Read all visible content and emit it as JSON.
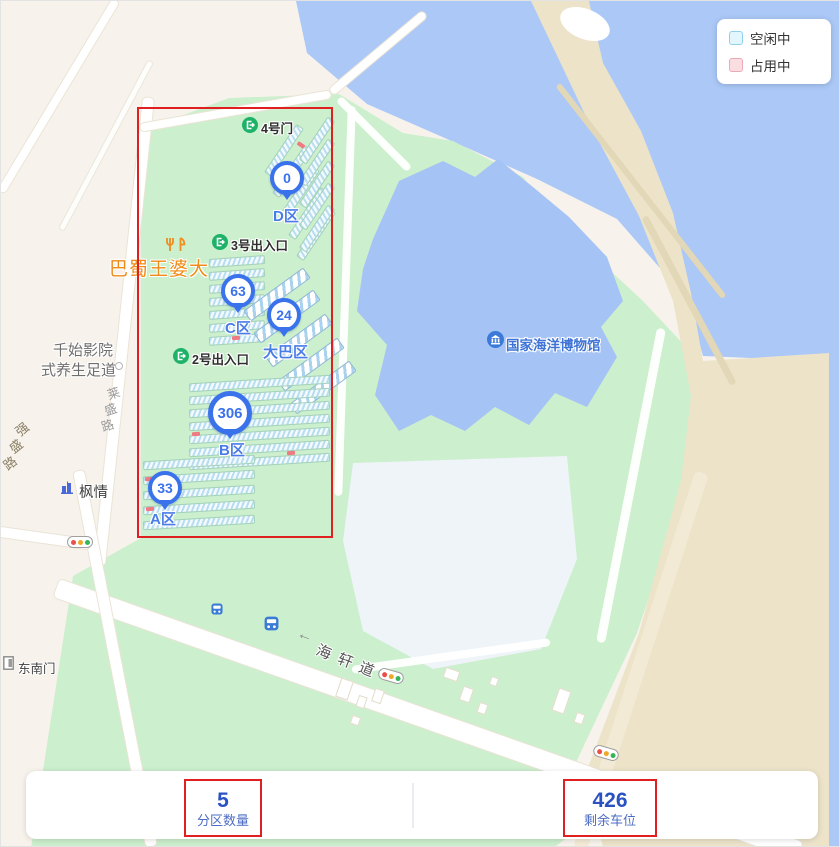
{
  "legend": {
    "free_label": "空闲中",
    "occupied_label": "占用中"
  },
  "zones": [
    {
      "id": "D",
      "count": "0",
      "label": "D区"
    },
    {
      "id": "C",
      "count": "63",
      "label": "C区"
    },
    {
      "id": "BUS",
      "count": "24",
      "label": "大巴区"
    },
    {
      "id": "B",
      "count": "306",
      "label": "B区"
    },
    {
      "id": "A",
      "count": "33",
      "label": "A区"
    }
  ],
  "gates": [
    {
      "label": "4号门"
    },
    {
      "label": "3号出入口"
    },
    {
      "label": "2号出入口"
    }
  ],
  "pois": {
    "restaurant": "巴蜀王婆大",
    "spa_line1": "千始影院",
    "spa_line2": "式养生足道",
    "fengqing": "枫情",
    "southeast_gate": "东南门",
    "museum": "国家海洋博物馆"
  },
  "roads": {
    "haixuan": "海轩道",
    "qiangsheng_chars": [
      "强",
      "盛",
      "路"
    ],
    "laisheng_chars": [
      "莱",
      "盛",
      "路"
    ],
    "arrow": "←"
  },
  "stats": {
    "zone_count_value": "5",
    "zone_count_label": "分区数量",
    "remaining_value": "426",
    "remaining_label": "剩余车位"
  },
  "colors": {
    "accent_blue": "#3a72ec",
    "annotation_red": "#e02020",
    "gate_green": "#1eb269",
    "water": "#abc8f7",
    "park_green": "#ccefcd",
    "free_fill": "#e4f6fd",
    "occupied_fill": "#fadde1"
  }
}
